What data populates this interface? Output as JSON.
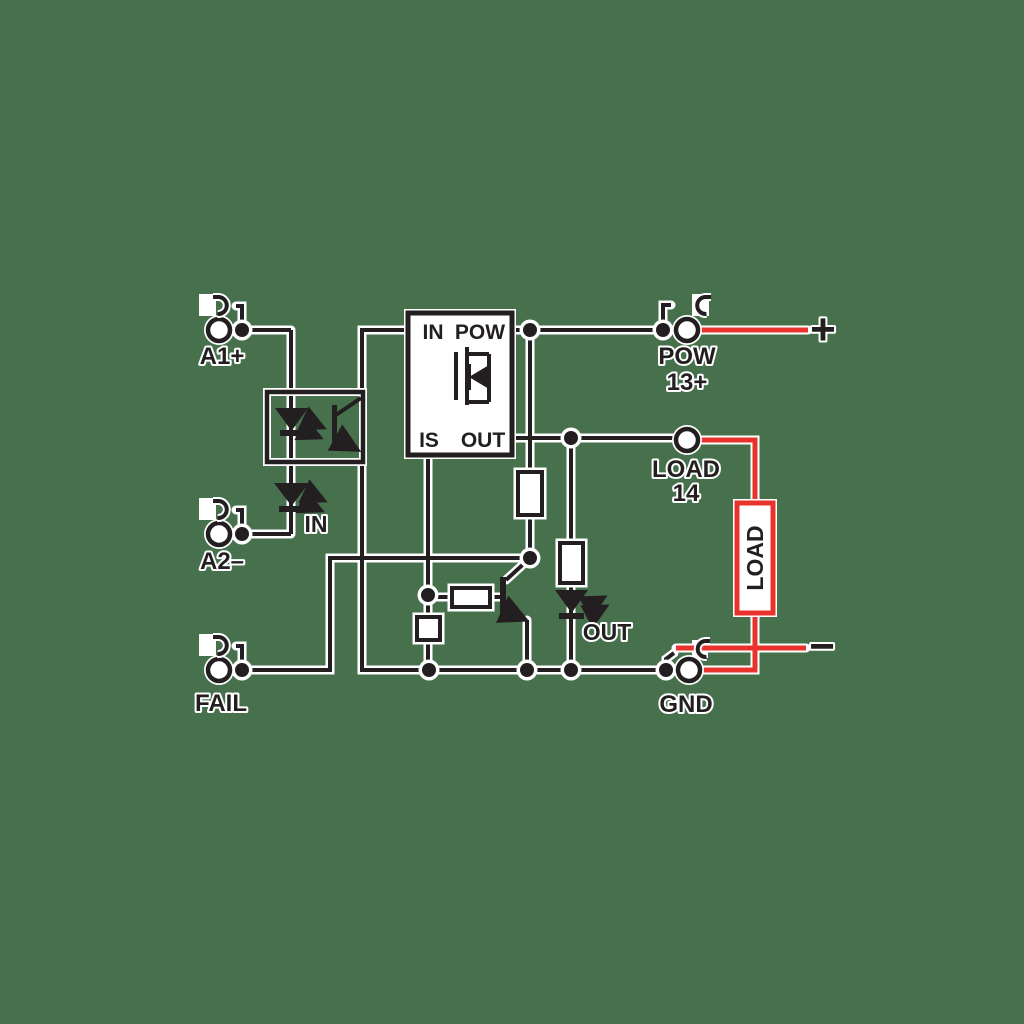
{
  "colors": {
    "background": "#47714d",
    "line": "#231f20",
    "wire_red": "#e8332c",
    "fill_white": "#ffffff"
  },
  "terminals": {
    "a1": {
      "label": "A1+"
    },
    "a2": {
      "label": "A2–"
    },
    "fail": {
      "label": "FAIL"
    },
    "pow": {
      "label": "POW",
      "pin": "13+"
    },
    "load": {
      "label": "LOAD",
      "pin": "14"
    },
    "gnd": {
      "label": "GND"
    }
  },
  "driver_block": {
    "pin_in": "IN",
    "pin_pow": "POW",
    "pin_is": "IS",
    "pin_out": "OUT"
  },
  "indicator_leds": {
    "input_label": "IN",
    "output_label": "OUT"
  },
  "load_box": {
    "label": "LOAD"
  },
  "polarity": {
    "positive": "+",
    "negative": "−"
  }
}
